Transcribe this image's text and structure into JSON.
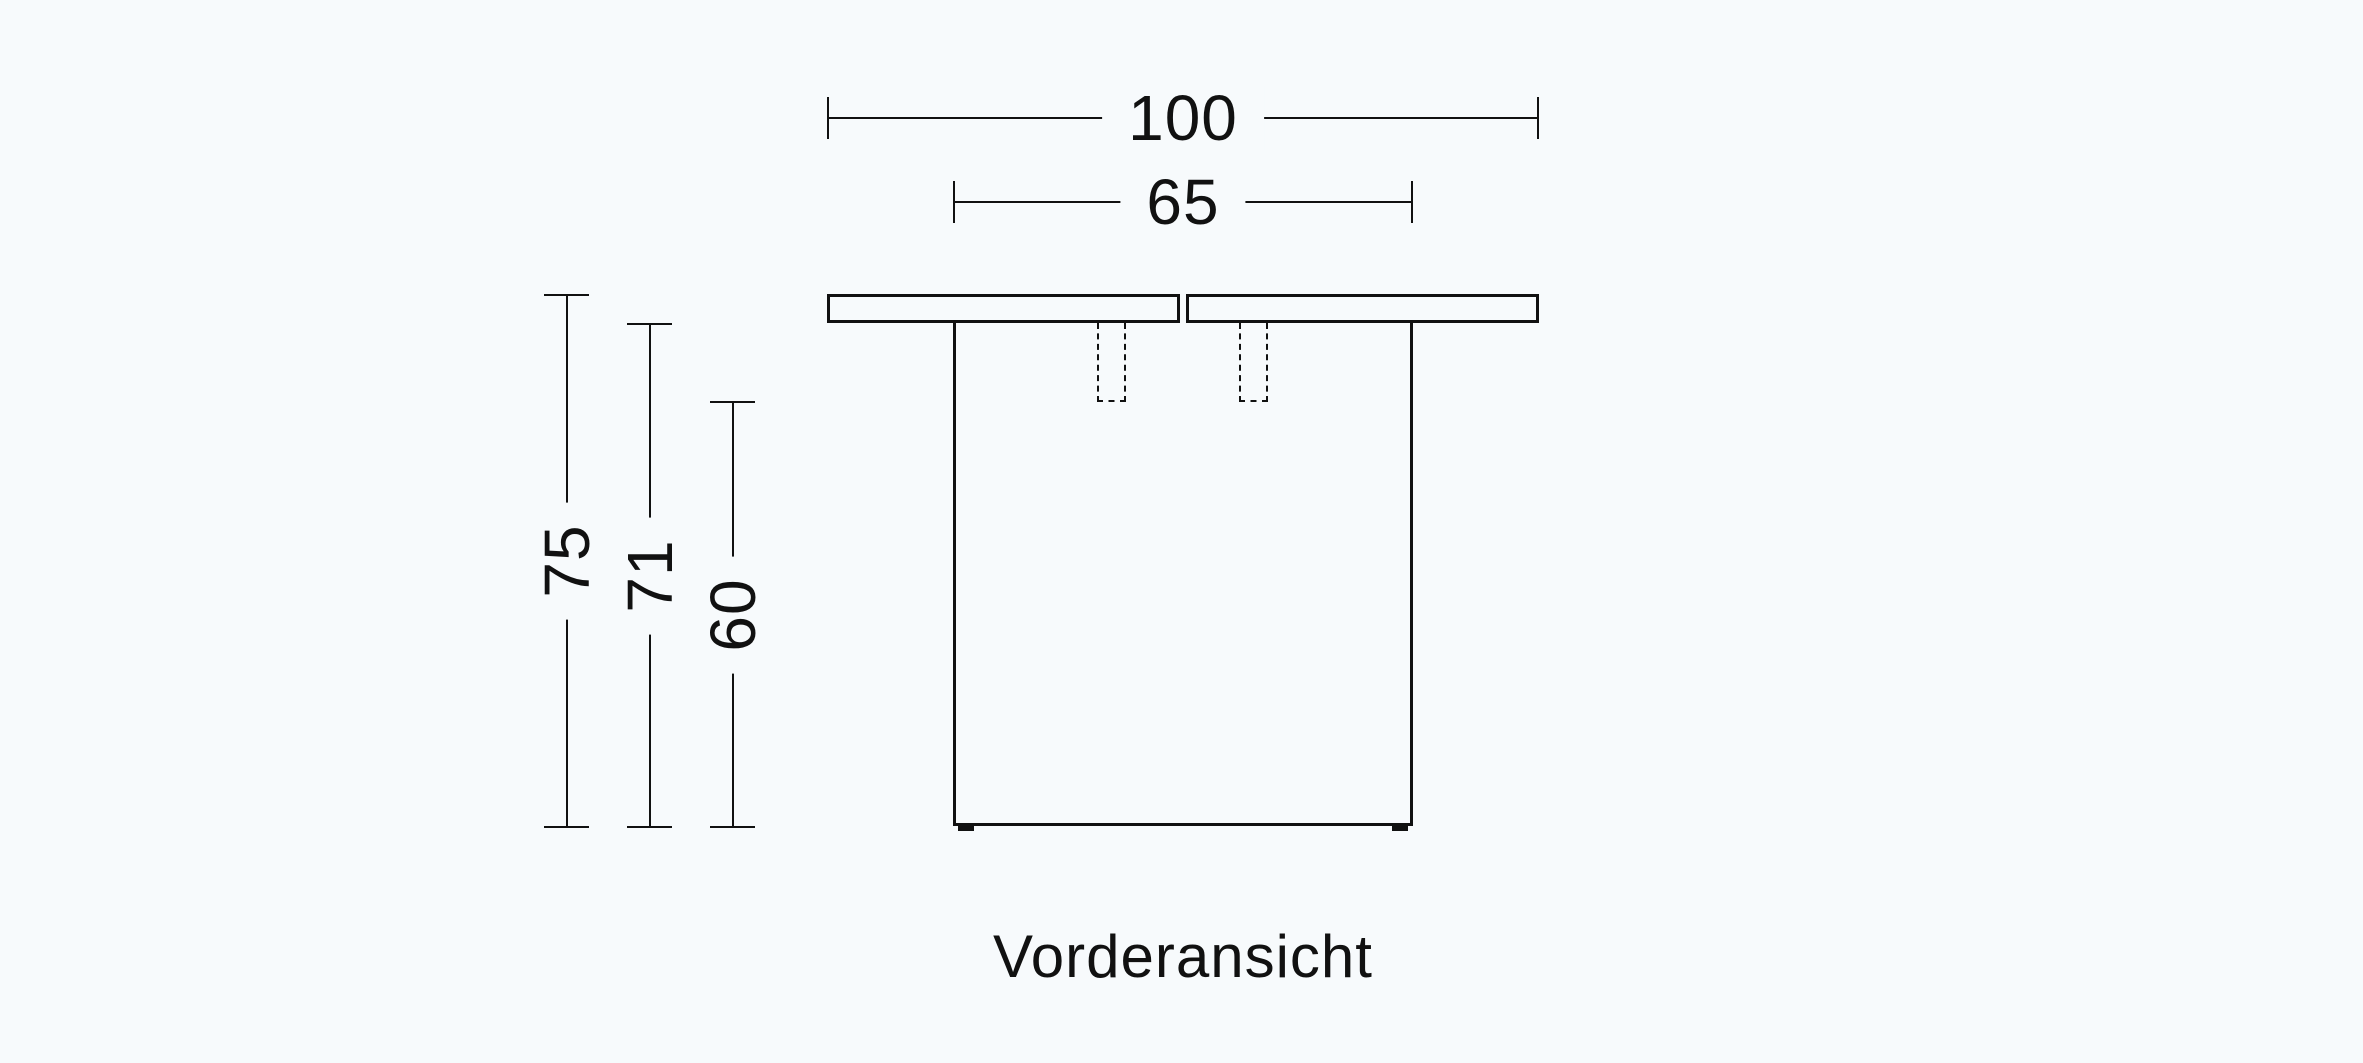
{
  "page": {
    "background_color": "#f7fafc",
    "line_color": "#111111"
  },
  "diagram": {
    "type": "technical-drawing",
    "caption": "Vorderansicht",
    "dimensions": {
      "total_width": {
        "value": "100",
        "orientation": "horizontal",
        "measures": "tabletop width"
      },
      "base_width": {
        "value": "65",
        "orientation": "horizontal",
        "measures": "pedestal width"
      },
      "total_height": {
        "value": "75",
        "orientation": "vertical",
        "measures": "overall height"
      },
      "height_under_top": {
        "value": "71",
        "orientation": "vertical",
        "measures": "height to underside of top"
      },
      "clearance_height": {
        "value": "60",
        "orientation": "vertical",
        "measures": "clearance under slide mechanism"
      }
    }
  }
}
